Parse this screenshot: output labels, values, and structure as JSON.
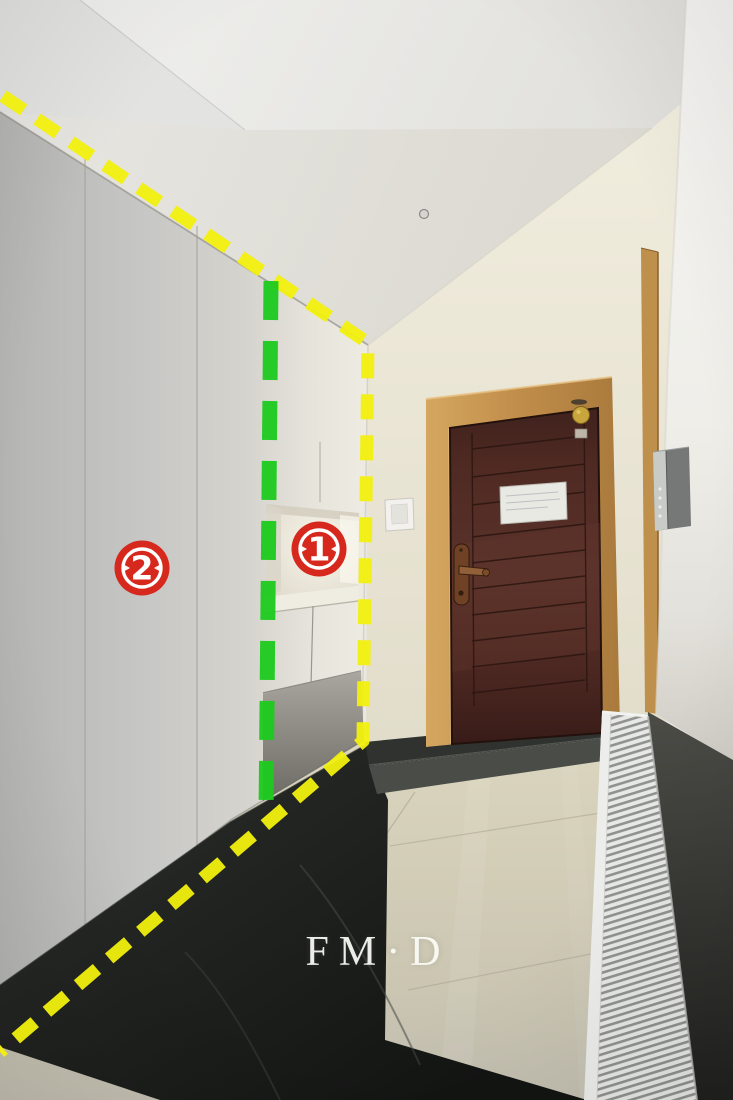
{
  "scene": {
    "type": "interior-photograph",
    "description": "Apartment entry hallway: white floor-to-ceiling shoe cabinet with an open display niche on the left, dark red-brown entry door in an oak frame at the end, silver intercom on the near wall, white panel radiator along the right wall, beige glossy tile floor with black marble border tiles and dark threshold step",
    "watermark": "FM·D",
    "objects": [
      "shoe-cabinet",
      "display-niche",
      "cabinet-doors",
      "entry-door",
      "door-frame",
      "door-sign",
      "door-handle",
      "gold-sticker",
      "light-switch",
      "intercom-panel",
      "radiator",
      "tile-floor",
      "black-border-tiles",
      "threshold-step"
    ]
  },
  "annotations": {
    "markers": [
      {
        "label": "1",
        "color": "#d7281e"
      },
      {
        "label": "2",
        "color": "#d7281e"
      }
    ],
    "lines": [
      {
        "name": "yellow-dashed-outline",
        "color": "#f2f00e",
        "style": "dashed"
      },
      {
        "name": "green-dashed-divider",
        "color": "#1ecb1e",
        "style": "dashed"
      }
    ]
  }
}
